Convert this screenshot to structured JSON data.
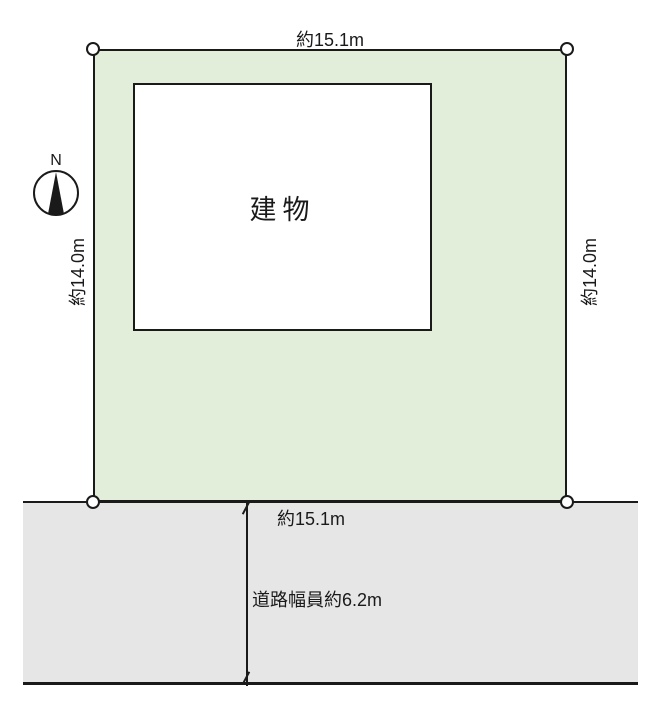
{
  "diagram": {
    "compass": {
      "label": "N"
    },
    "plot": {
      "top_dimension": "約15.1m",
      "left_dimension": "約14.0m",
      "right_dimension": "約14.0m",
      "fill": "#e2eed9"
    },
    "building": {
      "label": "建物",
      "fill": "#ffffff"
    },
    "road": {
      "frontage_dimension": "約15.1m",
      "width_label": "道路幅員約6.2m",
      "fill": "#e6e6e6"
    },
    "line_color": "#1a1a1a"
  }
}
